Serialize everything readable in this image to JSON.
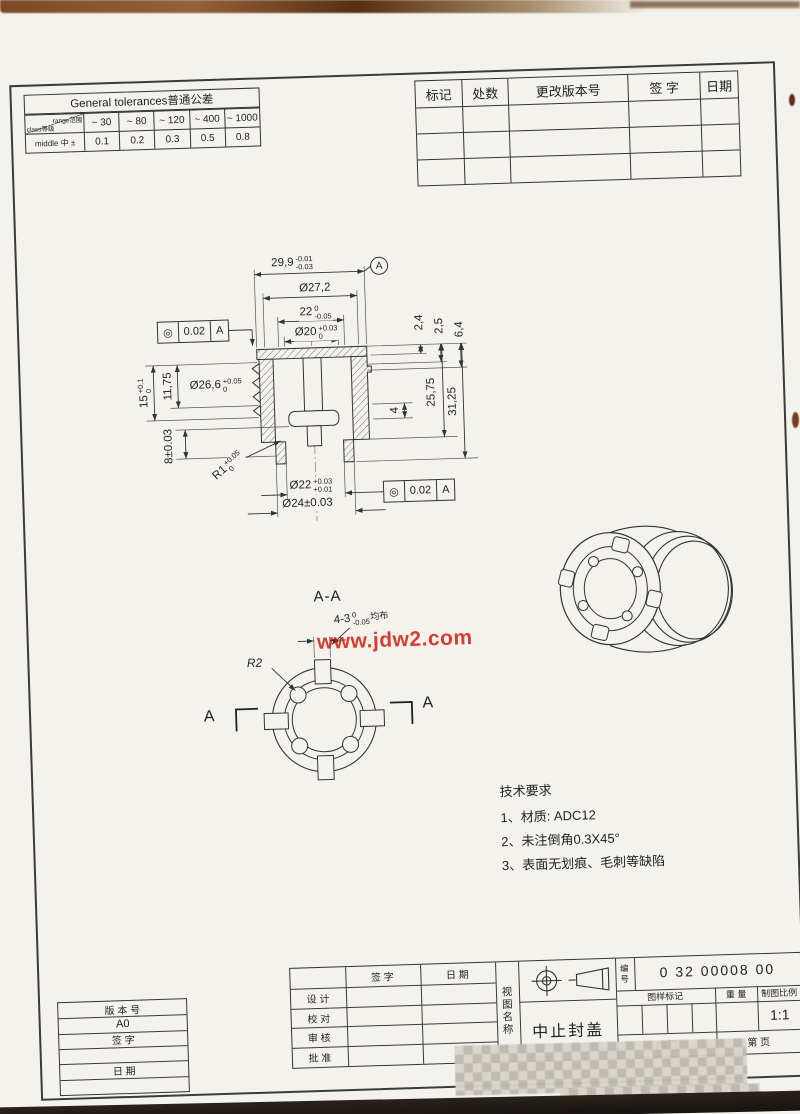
{
  "tol_table": {
    "title": "General tolerances普通公差",
    "corner_top": "range范围",
    "corner_bottom": "class等级",
    "ranges": [
      "~ 30",
      "~ 80",
      "~ 120",
      "~ 400",
      "~ 1000"
    ],
    "row_label": "middle 中 ±",
    "values": [
      "0.1",
      "0.2",
      "0.3",
      "0.5",
      "0.8"
    ]
  },
  "rev_table": {
    "headers": [
      "标记",
      "处数",
      "更改版本号",
      "签  字",
      "日期"
    ]
  },
  "main_view": {
    "gdt_symbol": "◎",
    "gdt_tol": "0.02",
    "gdt_datum": "A",
    "datum_label": "A",
    "dims": {
      "od_top": {
        "main": "29,9",
        "up": "-0.01",
        "low": "-0.03"
      },
      "d272": {
        "main": "Ø27,2"
      },
      "w22": {
        "main": "22",
        "up": "0",
        "low": "-0.05"
      },
      "d20": {
        "main": "Ø20",
        "up": "+0.03",
        "low": "0"
      },
      "h24": {
        "main": "2,4"
      },
      "h25": {
        "main": "2,5"
      },
      "h64": {
        "main": "6,4"
      },
      "d266": {
        "main": "Ø26,6",
        "up": "+0.05",
        "low": "0"
      },
      "h15": {
        "main": "15",
        "up": "+0.1",
        "low": "0"
      },
      "h1175": {
        "main": "11,75"
      },
      "h8": {
        "main": "8±0.03"
      },
      "r1": {
        "main": "R1",
        "up": "+0.05",
        "low": "0"
      },
      "h4": {
        "main": "4"
      },
      "h2575": {
        "main": "25,75"
      },
      "h3125": {
        "main": "31,25"
      },
      "d22": {
        "main": "Ø22",
        "up": "+0.03",
        "low": "+0.01"
      },
      "d24": {
        "main": "Ø24±0.03"
      }
    }
  },
  "section_view": {
    "label": "A-A",
    "slot_main": "4-3",
    "slot_up": "0",
    "slot_low": "-0.05",
    "slot_suffix": "均布",
    "r2": "R2",
    "cut_label": "A"
  },
  "watermark": "www.jdw2.com",
  "tech_req": {
    "title": "技术要求",
    "items": [
      "1、材质: ADC12",
      "2、未注倒角0.3X45°",
      "3、表面无划痕、毛刺等缺陷"
    ]
  },
  "title_block": {
    "sign_h": "签  字",
    "date_h": "日  期",
    "row_design": "设  计",
    "row_check": "校  对",
    "row_review": "审  核",
    "row_approve": "批  准",
    "view_name": "视图名称",
    "part_name": "中止封盖",
    "no_label": "编号",
    "drawing_no": "0 32 00008 00",
    "mark_h": "图样标记",
    "weight_h": "重  量",
    "scale_h": "制图比例",
    "scale_v": "1:1",
    "pages_total": "共    页",
    "pages_no": "第    页"
  },
  "version_box": {
    "label": "版 本 号",
    "version": "A0",
    "sign_label": "签  字",
    "date_label": "日  期"
  }
}
